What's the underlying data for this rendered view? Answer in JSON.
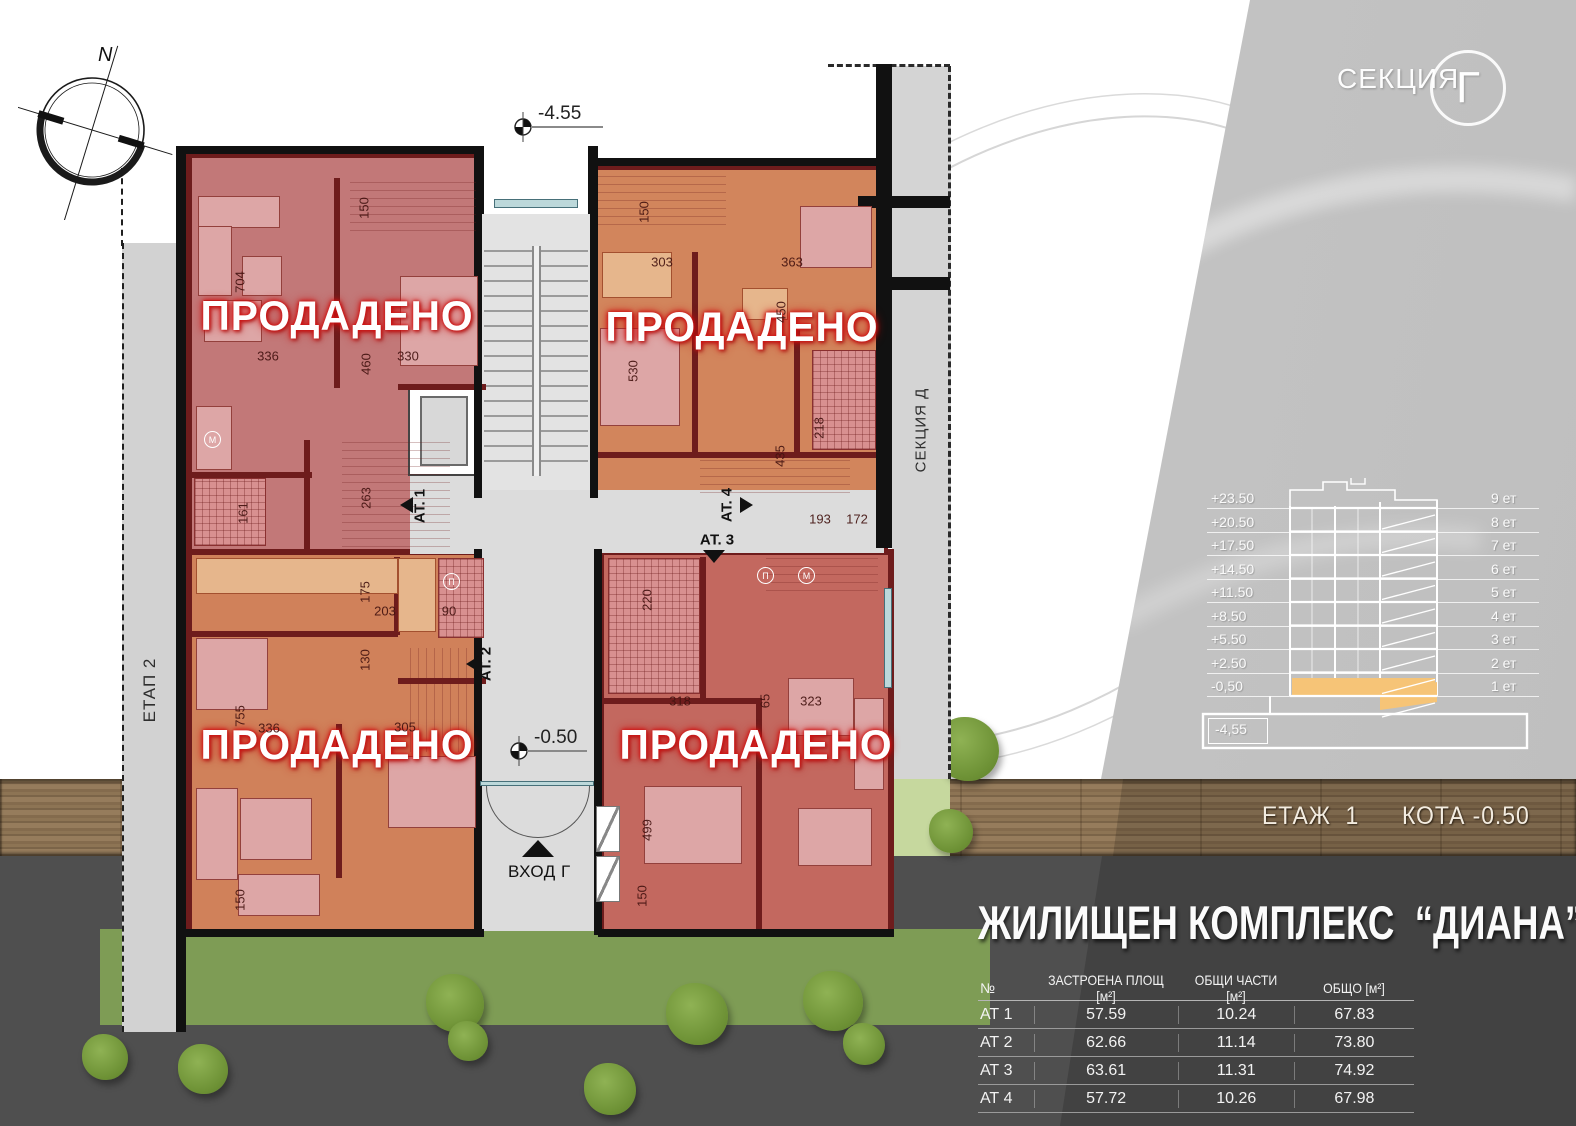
{
  "section_badge": {
    "label": "СЕКЦИЯ",
    "letter": "Г"
  },
  "compass_label": "N",
  "plan": {
    "stage_label": "ЕТАП 2",
    "adjacent_section": "СЕКЦИЯ Д",
    "entrance_label": "ВХОД Г",
    "markers": {
      "top": "-4.55",
      "entrance": "-0.50"
    },
    "sold_text": "ПРОДАДЕНО",
    "apartments": [
      {
        "label": "АТ. 1"
      },
      {
        "label": "АТ. 2"
      },
      {
        "label": "АТ. 3"
      },
      {
        "label": "АТ. 4"
      }
    ],
    "dimensions": [
      {
        "t": "704",
        "x": 240,
        "y": 282,
        "r": 90
      },
      {
        "t": "150",
        "x": 364,
        "y": 208,
        "r": 90
      },
      {
        "t": "336",
        "x": 268,
        "y": 356
      },
      {
        "t": "460",
        "x": 366,
        "y": 364,
        "r": 90
      },
      {
        "t": "330",
        "x": 408,
        "y": 356
      },
      {
        "t": "263",
        "x": 366,
        "y": 498,
        "r": 90
      },
      {
        "t": "161",
        "x": 243,
        "y": 513,
        "r": 90
      },
      {
        "t": "150",
        "x": 644,
        "y": 212,
        "r": 90
      },
      {
        "t": "303",
        "x": 662,
        "y": 262
      },
      {
        "t": "363",
        "x": 792,
        "y": 262
      },
      {
        "t": "450",
        "x": 781,
        "y": 312,
        "r": 90
      },
      {
        "t": "530",
        "x": 633,
        "y": 371,
        "r": 90
      },
      {
        "t": "435",
        "x": 780,
        "y": 456,
        "r": 90
      },
      {
        "t": "218",
        "x": 819,
        "y": 428,
        "r": 90
      },
      {
        "t": "193",
        "x": 820,
        "y": 519
      },
      {
        "t": "172",
        "x": 857,
        "y": 519
      },
      {
        "t": "175",
        "x": 365,
        "y": 592,
        "r": 90
      },
      {
        "t": "203",
        "x": 385,
        "y": 611
      },
      {
        "t": "90",
        "x": 449,
        "y": 611
      },
      {
        "t": "130",
        "x": 365,
        "y": 660,
        "r": 90
      },
      {
        "t": "755",
        "x": 240,
        "y": 716,
        "r": 90
      },
      {
        "t": "336",
        "x": 269,
        "y": 728
      },
      {
        "t": "305",
        "x": 405,
        "y": 727
      },
      {
        "t": "150",
        "x": 240,
        "y": 900,
        "r": 90
      },
      {
        "t": "220",
        "x": 647,
        "y": 600,
        "r": 90
      },
      {
        "t": "318",
        "x": 680,
        "y": 701
      },
      {
        "t": "323",
        "x": 811,
        "y": 701
      },
      {
        "t": "65",
        "x": 765,
        "y": 701,
        "r": 90
      },
      {
        "t": "499",
        "x": 647,
        "y": 830,
        "r": 90
      },
      {
        "t": "150",
        "x": 642,
        "y": 896,
        "r": 90
      }
    ]
  },
  "section_diagram": {
    "levels": [
      {
        "elevation": "+23.50",
        "floor": "9 ет"
      },
      {
        "elevation": "+20.50",
        "floor": "8 ет"
      },
      {
        "elevation": "+17.50",
        "floor": "7 ет"
      },
      {
        "elevation": "+14.50",
        "floor": "6 ет"
      },
      {
        "elevation": "+11.50",
        "floor": "5 ет"
      },
      {
        "elevation": "+8.50",
        "floor": "4 ет"
      },
      {
        "elevation": "+5.50",
        "floor": "3 ет"
      },
      {
        "elevation": "+2.50",
        "floor": "2 ет"
      },
      {
        "elevation": "-0,50",
        "floor": "1 ет"
      }
    ],
    "base_elevation": "-4,55"
  },
  "floor_banner": {
    "floor_label": "ЕТАЖ  1",
    "elevation_label": "КОТА -0.50"
  },
  "project_title": "ЖИЛИЩЕН КОМПЛЕКС  “ДИАНА”",
  "area_table": {
    "headers": [
      "№",
      "ЗАСТРОЕНА ПЛОЩ [м²]",
      "ОБЩИ ЧАСТИ [м²]",
      "ОБЩО [м²]"
    ],
    "rows": [
      {
        "id": "АТ 1",
        "built_up": "57.59",
        "common": "10.24",
        "total": "67.83"
      },
      {
        "id": "АТ 2",
        "built_up": "62.66",
        "common": "11.14",
        "total": "73.80"
      },
      {
        "id": "АТ 3",
        "built_up": "63.61",
        "common": "11.31",
        "total": "74.92"
      },
      {
        "id": "АТ 4",
        "built_up": "57.72",
        "common": "10.26",
        "total": "67.98"
      }
    ]
  }
}
